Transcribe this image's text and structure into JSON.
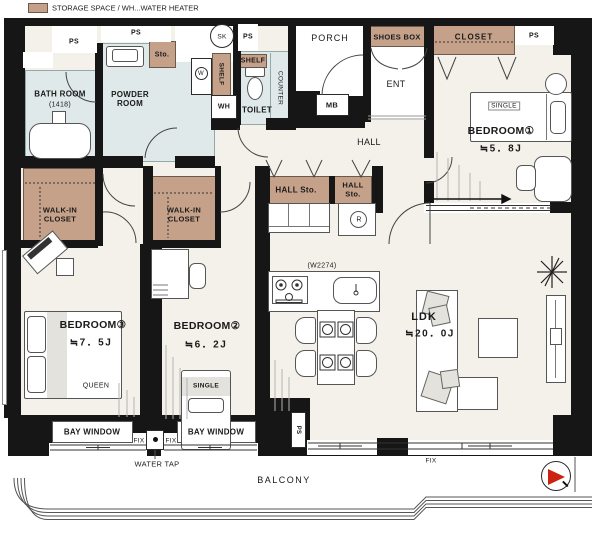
{
  "legend": {
    "text": "STORAGE SPACE / WH...WATER HEATER",
    "swatch_color": "#c5a189"
  },
  "colors": {
    "storage": "#c5a189",
    "wet_area": "#dfe9e9",
    "floor": "#f4f1ea",
    "wall": "#161616",
    "north_arrow": "#cc2211"
  },
  "rooms": {
    "bath": {
      "name": "BATH ROOM",
      "size": "(1418)"
    },
    "powder": {
      "line1": "POWDER",
      "line2": "ROOM"
    },
    "toilet": {
      "name": "TOILET"
    },
    "bedroom1": {
      "name": "BEDROOM①",
      "size": "≒5．8J",
      "bed": "SINGLE"
    },
    "bedroom2": {
      "name": "BEDROOM②",
      "size": "≒6．2J",
      "bed": "SINGLE"
    },
    "bedroom3": {
      "name": "BEDROOM③",
      "size": "≒7．5J",
      "bed": "QUEEN"
    },
    "ldk": {
      "name": "LDK",
      "size": "≒20．0J"
    }
  },
  "storage": {
    "shoes_box": "SHOES BOX",
    "closet": "CLOSET",
    "sto": "Sto.",
    "shelf": "SHELF",
    "hall_sto": "HALL Sto.",
    "hall_sto_line1": "HALL",
    "hall_sto_line2": "Sto.",
    "wic_line1": "WALK-IN",
    "wic_line2": "CLOSET"
  },
  "labels": {
    "ps": "PS",
    "wh": "WH",
    "sk": "SK",
    "mb": "MB",
    "w": "W",
    "r": "R",
    "counter": "COUNTER",
    "porch": "PORCH",
    "ent": "ENT",
    "hall": "HALL",
    "w2274": "(W2274)",
    "bay_window": "BAY WINDOW",
    "fix": "FIX",
    "water_tap": "WATER TAP",
    "balcony": "BALCONY"
  }
}
